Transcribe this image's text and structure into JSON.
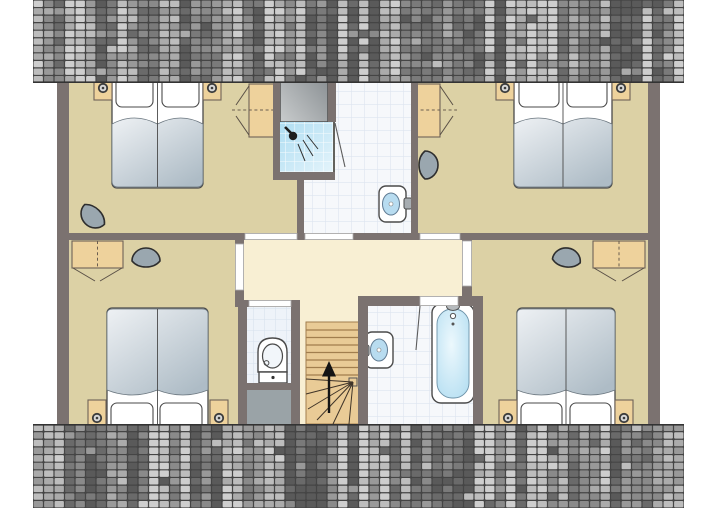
{
  "app": {
    "type": "floor-plan-drawing",
    "description": "upper floor plan of holiday house, no text labels visible"
  },
  "colors": {
    "wall": "#7b7270",
    "floor_tan": "#dcd1a5",
    "hall_cream": "#f8efd3",
    "tile_base": "#f6f8fb",
    "tile_line": "#dde4ef",
    "tile2_base": "#eef3f9",
    "tile2_line": "#d7e1ed",
    "shower_a": "#aeddf2",
    "shower_b": "#e4f4fb",
    "wood": "#eed29c",
    "wood_edge": "#6e6258",
    "stair_wood": "#e9cb96",
    "stair_line": "#a17e4e",
    "gray_area": "#9aa3a7",
    "flue_a": "#c9cccd",
    "flue_b": "#80868a",
    "chair_fill": "#9aa7af",
    "chair_stroke": "#2e2e2e",
    "bed_white": "#ffffff",
    "blanket_a": "#eef1f4",
    "blanket_b": "#aebcc6",
    "basin_blue": "#b8dcf0",
    "tub_a": "#ecf8fd",
    "tub_b": "#a5d7ee",
    "outline": "#4a4a4a",
    "door_leaf": "#ffffff",
    "roof_gap": "#454545",
    "roof_edge": "#333333",
    "roof_palette": [
      "#cecece",
      "#bdbdbd",
      "#ababab",
      "#999999",
      "#8a8a8a",
      "#7a7a7a",
      "#6a6a6a",
      "#5a5a5a"
    ]
  },
  "roof": {
    "bands": [
      {
        "x": 33,
        "y": 0,
        "w": 651,
        "h": 83
      },
      {
        "x": 33,
        "y": 424,
        "w": 651,
        "h": 84
      }
    ],
    "cols": 62,
    "rows": 11,
    "seed": 13
  },
  "floorplan": {
    "stairs_direction": "up",
    "rooms": [
      {
        "id": "bedroom-top-left",
        "type": "bedroom",
        "furniture": [
          "twin-beds",
          "nightstand-left",
          "nightstand-right",
          "wardrobe",
          "chair"
        ]
      },
      {
        "id": "bedroom-top-right",
        "type": "bedroom",
        "furniture": [
          "twin-beds",
          "nightstand-left",
          "nightstand-right",
          "wardrobe",
          "chair"
        ]
      },
      {
        "id": "bathroom-top",
        "type": "bathroom",
        "furniture": [
          "shower",
          "washbasin"
        ]
      },
      {
        "id": "flue-closet",
        "type": "service",
        "furniture": []
      },
      {
        "id": "hallway",
        "type": "hall",
        "furniture": []
      },
      {
        "id": "toilet-room",
        "type": "wc",
        "furniture": [
          "toilet"
        ]
      },
      {
        "id": "staircase",
        "type": "stairs",
        "furniture": [
          "winder-stairs",
          "up-arrow"
        ]
      },
      {
        "id": "bathroom-bottom",
        "type": "bathroom",
        "furniture": [
          "bathtub",
          "washbasin"
        ]
      },
      {
        "id": "bedroom-bottom-left",
        "type": "bedroom",
        "furniture": [
          "twin-beds",
          "nightstand-left",
          "nightstand-right",
          "wardrobe",
          "chair"
        ]
      },
      {
        "id": "bedroom-bottom-right",
        "type": "bedroom",
        "furniture": [
          "twin-beds",
          "nightstand-left",
          "nightstand-right",
          "wardrobe",
          "chair"
        ]
      }
    ]
  }
}
